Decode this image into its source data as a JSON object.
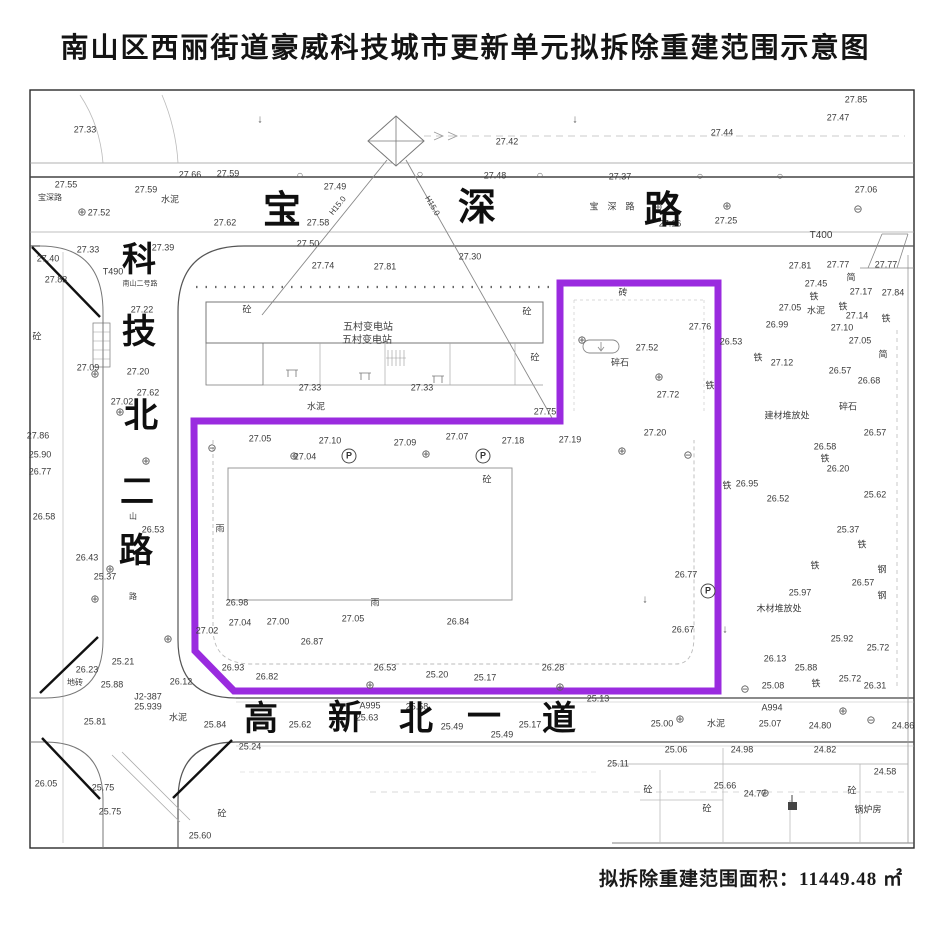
{
  "title": "南山区西丽街道豪威科技城市更新单元拟拆除重建范围示意图",
  "footer": {
    "area_text": "拟拆除重建范围面积：11449.48 ㎡"
  },
  "map": {
    "boundary_color": "#9a2bdf",
    "streets": [
      {
        "id": "baoshen",
        "name": "宝深路",
        "chars": [
          {
            "c": "宝",
            "x": 282,
            "y": 211,
            "s": 38
          },
          {
            "c": "深",
            "x": 477,
            "y": 208,
            "s": 38
          },
          {
            "c": "路",
            "x": 663,
            "y": 211,
            "s": 38
          }
        ]
      },
      {
        "id": "kejibei2",
        "name": "科技北二路",
        "chars": [
          {
            "c": "科",
            "x": 139,
            "y": 261,
            "s": 34
          },
          {
            "c": "技",
            "x": 139,
            "y": 333,
            "s": 34
          },
          {
            "c": "北",
            "x": 141,
            "y": 417,
            "s": 34
          },
          {
            "c": "二",
            "x": 137,
            "y": 493,
            "s": 34
          },
          {
            "c": "路",
            "x": 136,
            "y": 552,
            "s": 34
          }
        ]
      },
      {
        "id": "gaoxinbei1",
        "name": "高新北一道",
        "chars": [
          {
            "c": "高",
            "x": 261,
            "y": 720,
            "s": 34
          },
          {
            "c": "新",
            "x": 345,
            "y": 719,
            "s": 34
          },
          {
            "c": "北",
            "x": 416,
            "y": 720,
            "s": 34
          },
          {
            "c": "一",
            "x": 484,
            "y": 718,
            "s": 34
          },
          {
            "c": "道",
            "x": 559,
            "y": 720,
            "s": 34
          }
        ]
      }
    ],
    "labels": [
      {
        "t": "27.33",
        "x": 85,
        "y": 130
      },
      {
        "t": "27.85",
        "x": 856,
        "y": 100
      },
      {
        "t": "27.47",
        "x": 838,
        "y": 118
      },
      {
        "t": "27.44",
        "x": 722,
        "y": 133
      },
      {
        "t": "27.42",
        "x": 507,
        "y": 142
      },
      {
        "t": "27.48",
        "x": 495,
        "y": 176
      },
      {
        "t": "27.55",
        "x": 66,
        "y": 185
      },
      {
        "t": "27.59",
        "x": 146,
        "y": 190
      },
      {
        "t": "水泥",
        "x": 170,
        "y": 200
      },
      {
        "t": "宝深路",
        "x": 50,
        "y": 198,
        "s": 8
      },
      {
        "t": "⊕",
        "x": 82,
        "y": 213,
        "cls": "sym"
      },
      {
        "t": "27.52",
        "x": 99,
        "y": 213
      },
      {
        "t": "27.66",
        "x": 190,
        "y": 175
      },
      {
        "t": "27.59",
        "x": 228,
        "y": 174
      },
      {
        "t": "27.49",
        "x": 335,
        "y": 187
      },
      {
        "t": "27.37",
        "x": 620,
        "y": 177
      },
      {
        "t": "27.16",
        "x": 670,
        "y": 224
      },
      {
        "t": "27.25",
        "x": 726,
        "y": 221
      },
      {
        "t": "27.06",
        "x": 866,
        "y": 190
      },
      {
        "t": "T400",
        "x": 821,
        "y": 236,
        "s": 10
      },
      {
        "t": "宝",
        "x": 594,
        "y": 207,
        "s": 9
      },
      {
        "t": "深",
        "x": 612,
        "y": 207,
        "s": 9
      },
      {
        "t": "路",
        "x": 630,
        "y": 207,
        "s": 9
      },
      {
        "t": "27.62",
        "x": 225,
        "y": 223
      },
      {
        "t": "27.58",
        "x": 318,
        "y": 223
      },
      {
        "t": "27.50",
        "x": 308,
        "y": 244
      },
      {
        "t": "27.74",
        "x": 323,
        "y": 266
      },
      {
        "t": "27.81",
        "x": 385,
        "y": 267
      },
      {
        "t": "27.30",
        "x": 470,
        "y": 257
      },
      {
        "t": "H15.0",
        "x": 338,
        "y": 206,
        "r": -51,
        "s": 8
      },
      {
        "t": "H15.0",
        "x": 432,
        "y": 206,
        "r": 60,
        "s": 8
      },
      {
        "t": "27.40",
        "x": 48,
        "y": 259
      },
      {
        "t": "27.33",
        "x": 88,
        "y": 250
      },
      {
        "t": "27.39",
        "x": 163,
        "y": 248
      },
      {
        "t": "27.83",
        "x": 56,
        "y": 280
      },
      {
        "t": "T490",
        "x": 113,
        "y": 272
      },
      {
        "t": "南山二号路",
        "x": 140,
        "y": 284,
        "s": 7
      },
      {
        "t": "27.22",
        "x": 142,
        "y": 310
      },
      {
        "t": "砼",
        "x": 37,
        "y": 337
      },
      {
        "t": "27.09",
        "x": 88,
        "y": 368
      },
      {
        "t": "27.20",
        "x": 138,
        "y": 372
      },
      {
        "t": "27.62",
        "x": 148,
        "y": 393
      },
      {
        "t": "27.02",
        "x": 122,
        "y": 402
      },
      {
        "t": "27.86",
        "x": 38,
        "y": 436
      },
      {
        "t": "25.90",
        "x": 40,
        "y": 455
      },
      {
        "t": "26.77",
        "x": 40,
        "y": 472
      },
      {
        "t": "26.58",
        "x": 44,
        "y": 517
      },
      {
        "t": "26.53",
        "x": 153,
        "y": 530
      },
      {
        "t": "山",
        "x": 133,
        "y": 517,
        "s": 8
      },
      {
        "t": "路",
        "x": 133,
        "y": 597,
        "s": 8
      },
      {
        "t": "26.43",
        "x": 87,
        "y": 558
      },
      {
        "t": "25.37",
        "x": 105,
        "y": 577
      },
      {
        "t": "25.21",
        "x": 123,
        "y": 662
      },
      {
        "t": "26.23",
        "x": 87,
        "y": 670
      },
      {
        "t": "25.88",
        "x": 112,
        "y": 685
      },
      {
        "t": "地砖",
        "x": 75,
        "y": 683,
        "s": 8
      },
      {
        "t": "26.12",
        "x": 181,
        "y": 682
      },
      {
        "t": "J2-387",
        "x": 148,
        "y": 697
      },
      {
        "t": "25.939",
        "x": 148,
        "y": 707
      },
      {
        "t": "25.81",
        "x": 95,
        "y": 722
      },
      {
        "t": "水泥",
        "x": 178,
        "y": 718
      },
      {
        "t": "25.84",
        "x": 215,
        "y": 725
      },
      {
        "t": "26.05",
        "x": 46,
        "y": 784
      },
      {
        "t": "25.75",
        "x": 103,
        "y": 788
      },
      {
        "t": "25.75",
        "x": 110,
        "y": 812
      },
      {
        "t": "25.24",
        "x": 250,
        "y": 747
      },
      {
        "t": "25.60",
        "x": 200,
        "y": 836
      },
      {
        "t": "砼",
        "x": 222,
        "y": 814
      },
      {
        "t": "砼",
        "x": 247,
        "y": 310
      },
      {
        "t": "砼",
        "x": 527,
        "y": 312
      },
      {
        "t": "砼",
        "x": 535,
        "y": 358
      },
      {
        "t": "五村变电站",
        "x": 368,
        "y": 328,
        "s": 10
      },
      {
        "t": "五村变电站",
        "x": 367,
        "y": 341,
        "s": 10
      },
      {
        "t": "27.33",
        "x": 310,
        "y": 388
      },
      {
        "t": "27.33",
        "x": 422,
        "y": 388
      },
      {
        "t": "水泥",
        "x": 316,
        "y": 407
      },
      {
        "t": "27.75",
        "x": 545,
        "y": 412
      },
      {
        "t": "27.05",
        "x": 260,
        "y": 439
      },
      {
        "t": "27.10",
        "x": 330,
        "y": 441
      },
      {
        "t": "27.09",
        "x": 405,
        "y": 443
      },
      {
        "t": "27.07",
        "x": 457,
        "y": 437
      },
      {
        "t": "27.18",
        "x": 513,
        "y": 441
      },
      {
        "t": "27.19",
        "x": 570,
        "y": 440
      },
      {
        "t": "27.04",
        "x": 305,
        "y": 457
      },
      {
        "t": "P",
        "x": 349,
        "y": 456,
        "cls": "circle"
      },
      {
        "t": "P",
        "x": 483,
        "y": 456,
        "cls": "circle"
      },
      {
        "t": "砼",
        "x": 487,
        "y": 480
      },
      {
        "t": "雨",
        "x": 220,
        "y": 529
      },
      {
        "t": "26.98",
        "x": 237,
        "y": 603
      },
      {
        "t": "雨",
        "x": 375,
        "y": 603
      },
      {
        "t": "27.02",
        "x": 207,
        "y": 631
      },
      {
        "t": "27.04",
        "x": 240,
        "y": 623
      },
      {
        "t": "27.00",
        "x": 278,
        "y": 622
      },
      {
        "t": "27.05",
        "x": 353,
        "y": 619
      },
      {
        "t": "26.87",
        "x": 312,
        "y": 642
      },
      {
        "t": "26.84",
        "x": 458,
        "y": 622
      },
      {
        "t": "26.93",
        "x": 233,
        "y": 668
      },
      {
        "t": "26.82",
        "x": 267,
        "y": 677
      },
      {
        "t": "26.53",
        "x": 385,
        "y": 668
      },
      {
        "t": "25.20",
        "x": 437,
        "y": 675
      },
      {
        "t": "25.17",
        "x": 485,
        "y": 678
      },
      {
        "t": "26.28",
        "x": 553,
        "y": 668
      },
      {
        "t": "砖",
        "x": 623,
        "y": 293
      },
      {
        "t": "27.76",
        "x": 700,
        "y": 327
      },
      {
        "t": "27.52",
        "x": 647,
        "y": 348
      },
      {
        "t": "碎石",
        "x": 620,
        "y": 363
      },
      {
        "t": "27.72",
        "x": 668,
        "y": 395
      },
      {
        "t": "铁",
        "x": 710,
        "y": 386
      },
      {
        "t": "27.20",
        "x": 655,
        "y": 433
      },
      {
        "t": "26.77",
        "x": 686,
        "y": 575
      },
      {
        "t": "26.67",
        "x": 683,
        "y": 630
      },
      {
        "t": "P",
        "x": 708,
        "y": 591,
        "cls": "circle"
      },
      {
        "t": "27.81",
        "x": 800,
        "y": 266
      },
      {
        "t": "27.77",
        "x": 838,
        "y": 265
      },
      {
        "t": "27.77",
        "x": 886,
        "y": 265
      },
      {
        "t": "简",
        "x": 851,
        "y": 278
      },
      {
        "t": "27.45",
        "x": 816,
        "y": 284
      },
      {
        "t": "铁",
        "x": 814,
        "y": 297
      },
      {
        "t": "27.17",
        "x": 861,
        "y": 292
      },
      {
        "t": "27.84",
        "x": 893,
        "y": 293
      },
      {
        "t": "27.05",
        "x": 790,
        "y": 308
      },
      {
        "t": "水泥",
        "x": 816,
        "y": 311
      },
      {
        "t": "铁",
        "x": 843,
        "y": 307
      },
      {
        "t": "27.14",
        "x": 857,
        "y": 316
      },
      {
        "t": "26.99",
        "x": 777,
        "y": 325
      },
      {
        "t": "27.10",
        "x": 842,
        "y": 328
      },
      {
        "t": "铁",
        "x": 886,
        "y": 319
      },
      {
        "t": "27.05",
        "x": 860,
        "y": 341
      },
      {
        "t": "简",
        "x": 883,
        "y": 355
      },
      {
        "t": "26.53",
        "x": 731,
        "y": 342
      },
      {
        "t": "铁",
        "x": 758,
        "y": 358
      },
      {
        "t": "27.12",
        "x": 782,
        "y": 363
      },
      {
        "t": "26.57",
        "x": 840,
        "y": 371
      },
      {
        "t": "26.68",
        "x": 869,
        "y": 381
      },
      {
        "t": "碎石",
        "x": 848,
        "y": 407
      },
      {
        "t": "建材堆放处",
        "x": 787,
        "y": 416
      },
      {
        "t": "26.57",
        "x": 875,
        "y": 433
      },
      {
        "t": "26.58",
        "x": 825,
        "y": 447
      },
      {
        "t": "铁",
        "x": 825,
        "y": 459
      },
      {
        "t": "26.20",
        "x": 838,
        "y": 469
      },
      {
        "t": "铁",
        "x": 727,
        "y": 486
      },
      {
        "t": "26.95",
        "x": 747,
        "y": 484
      },
      {
        "t": "26.52",
        "x": 778,
        "y": 499
      },
      {
        "t": "25.62",
        "x": 875,
        "y": 495
      },
      {
        "t": "25.37",
        "x": 848,
        "y": 530
      },
      {
        "t": "铁",
        "x": 862,
        "y": 545
      },
      {
        "t": "钢",
        "x": 882,
        "y": 570
      },
      {
        "t": "铁",
        "x": 815,
        "y": 566
      },
      {
        "t": "26.57",
        "x": 863,
        "y": 583
      },
      {
        "t": "钢",
        "x": 882,
        "y": 596
      },
      {
        "t": "25.97",
        "x": 800,
        "y": 593
      },
      {
        "t": "木材堆放处",
        "x": 779,
        "y": 609
      },
      {
        "t": "25.92",
        "x": 842,
        "y": 639
      },
      {
        "t": "25.72",
        "x": 878,
        "y": 648
      },
      {
        "t": "26.13",
        "x": 775,
        "y": 659
      },
      {
        "t": "25.88",
        "x": 806,
        "y": 668
      },
      {
        "t": "25.08",
        "x": 773,
        "y": 686
      },
      {
        "t": "铁",
        "x": 816,
        "y": 684
      },
      {
        "t": "25.72",
        "x": 850,
        "y": 679
      },
      {
        "t": "26.31",
        "x": 875,
        "y": 686
      },
      {
        "t": "25.13",
        "x": 598,
        "y": 699
      },
      {
        "t": "A995",
        "x": 370,
        "y": 706
      },
      {
        "t": "25.63",
        "x": 367,
        "y": 718
      },
      {
        "t": "25.62",
        "x": 300,
        "y": 725
      },
      {
        "t": "25.58",
        "x": 417,
        "y": 707
      },
      {
        "t": "25.49",
        "x": 452,
        "y": 727
      },
      {
        "t": "25.49",
        "x": 502,
        "y": 735
      },
      {
        "t": "25.17",
        "x": 530,
        "y": 725
      },
      {
        "t": "水泥",
        "x": 716,
        "y": 724
      },
      {
        "t": "A994",
        "x": 772,
        "y": 708
      },
      {
        "t": "25.07",
        "x": 770,
        "y": 724
      },
      {
        "t": "25.00",
        "x": 662,
        "y": 724
      },
      {
        "t": "24.80",
        "x": 820,
        "y": 726
      },
      {
        "t": "24.86",
        "x": 903,
        "y": 726
      },
      {
        "t": "25.06",
        "x": 676,
        "y": 750
      },
      {
        "t": "24.98",
        "x": 742,
        "y": 750
      },
      {
        "t": "24.82",
        "x": 825,
        "y": 750
      },
      {
        "t": "25.11",
        "x": 618,
        "y": 764
      },
      {
        "t": "砼",
        "x": 648,
        "y": 790
      },
      {
        "t": "25.66",
        "x": 725,
        "y": 786
      },
      {
        "t": "24.77",
        "x": 755,
        "y": 794
      },
      {
        "t": "砼",
        "x": 707,
        "y": 809
      },
      {
        "t": "24.58",
        "x": 885,
        "y": 772
      },
      {
        "t": "锅炉房",
        "x": 868,
        "y": 810
      },
      {
        "t": "砼",
        "x": 852,
        "y": 791
      },
      {
        "t": "⊕",
        "x": 146,
        "y": 462,
        "cls": "sym"
      },
      {
        "t": "⊕",
        "x": 294,
        "y": 457,
        "cls": "sym"
      },
      {
        "t": "⊕",
        "x": 426,
        "y": 455,
        "cls": "sym"
      },
      {
        "t": "⊕",
        "x": 622,
        "y": 452,
        "cls": "sym"
      },
      {
        "t": "⊕",
        "x": 370,
        "y": 686,
        "cls": "sym"
      },
      {
        "t": "⊕",
        "x": 560,
        "y": 688,
        "cls": "sym"
      },
      {
        "t": "⊕",
        "x": 843,
        "y": 712,
        "cls": "sym"
      },
      {
        "t": "⊕",
        "x": 680,
        "y": 720,
        "cls": "sym"
      },
      {
        "t": "⊕",
        "x": 765,
        "y": 794,
        "cls": "sym"
      },
      {
        "t": "⊕",
        "x": 168,
        "y": 640,
        "cls": "sym"
      },
      {
        "t": "⊕",
        "x": 95,
        "y": 600,
        "cls": "sym"
      },
      {
        "t": "⊕",
        "x": 110,
        "y": 570,
        "cls": "sym"
      },
      {
        "t": "⊕",
        "x": 95,
        "y": 375,
        "cls": "sym"
      },
      {
        "t": "⊕",
        "x": 120,
        "y": 413,
        "cls": "sym"
      },
      {
        "t": "⊕",
        "x": 659,
        "y": 378,
        "cls": "sym"
      },
      {
        "t": "⊕",
        "x": 582,
        "y": 341,
        "cls": "sym"
      },
      {
        "t": "⊕",
        "x": 658,
        "y": 208,
        "cls": "sym"
      },
      {
        "t": "⊕",
        "x": 727,
        "y": 207,
        "cls": "sym"
      },
      {
        "t": "⊖",
        "x": 858,
        "y": 210,
        "cls": "sym"
      },
      {
        "t": "⊖",
        "x": 745,
        "y": 690,
        "cls": "sym"
      },
      {
        "t": "⊖",
        "x": 871,
        "y": 721,
        "cls": "sym"
      },
      {
        "t": "⊖",
        "x": 212,
        "y": 449,
        "cls": "sym"
      },
      {
        "t": "⊖",
        "x": 688,
        "y": 456,
        "cls": "sym"
      },
      {
        "t": "○",
        "x": 300,
        "y": 176,
        "cls": "sym"
      },
      {
        "t": "○",
        "x": 420,
        "y": 175,
        "cls": "sym"
      },
      {
        "t": "○",
        "x": 540,
        "y": 176,
        "cls": "sym"
      },
      {
        "t": "○",
        "x": 700,
        "y": 177,
        "cls": "sym"
      },
      {
        "t": "○",
        "x": 780,
        "y": 177,
        "cls": "sym"
      },
      {
        "t": "↓",
        "x": 260,
        "y": 120,
        "cls": "sym"
      },
      {
        "t": "↓",
        "x": 575,
        "y": 120,
        "cls": "sym"
      },
      {
        "t": "↓",
        "x": 645,
        "y": 600,
        "cls": "sym"
      },
      {
        "t": "↓",
        "x": 725,
        "y": 630,
        "cls": "sym"
      }
    ]
  }
}
